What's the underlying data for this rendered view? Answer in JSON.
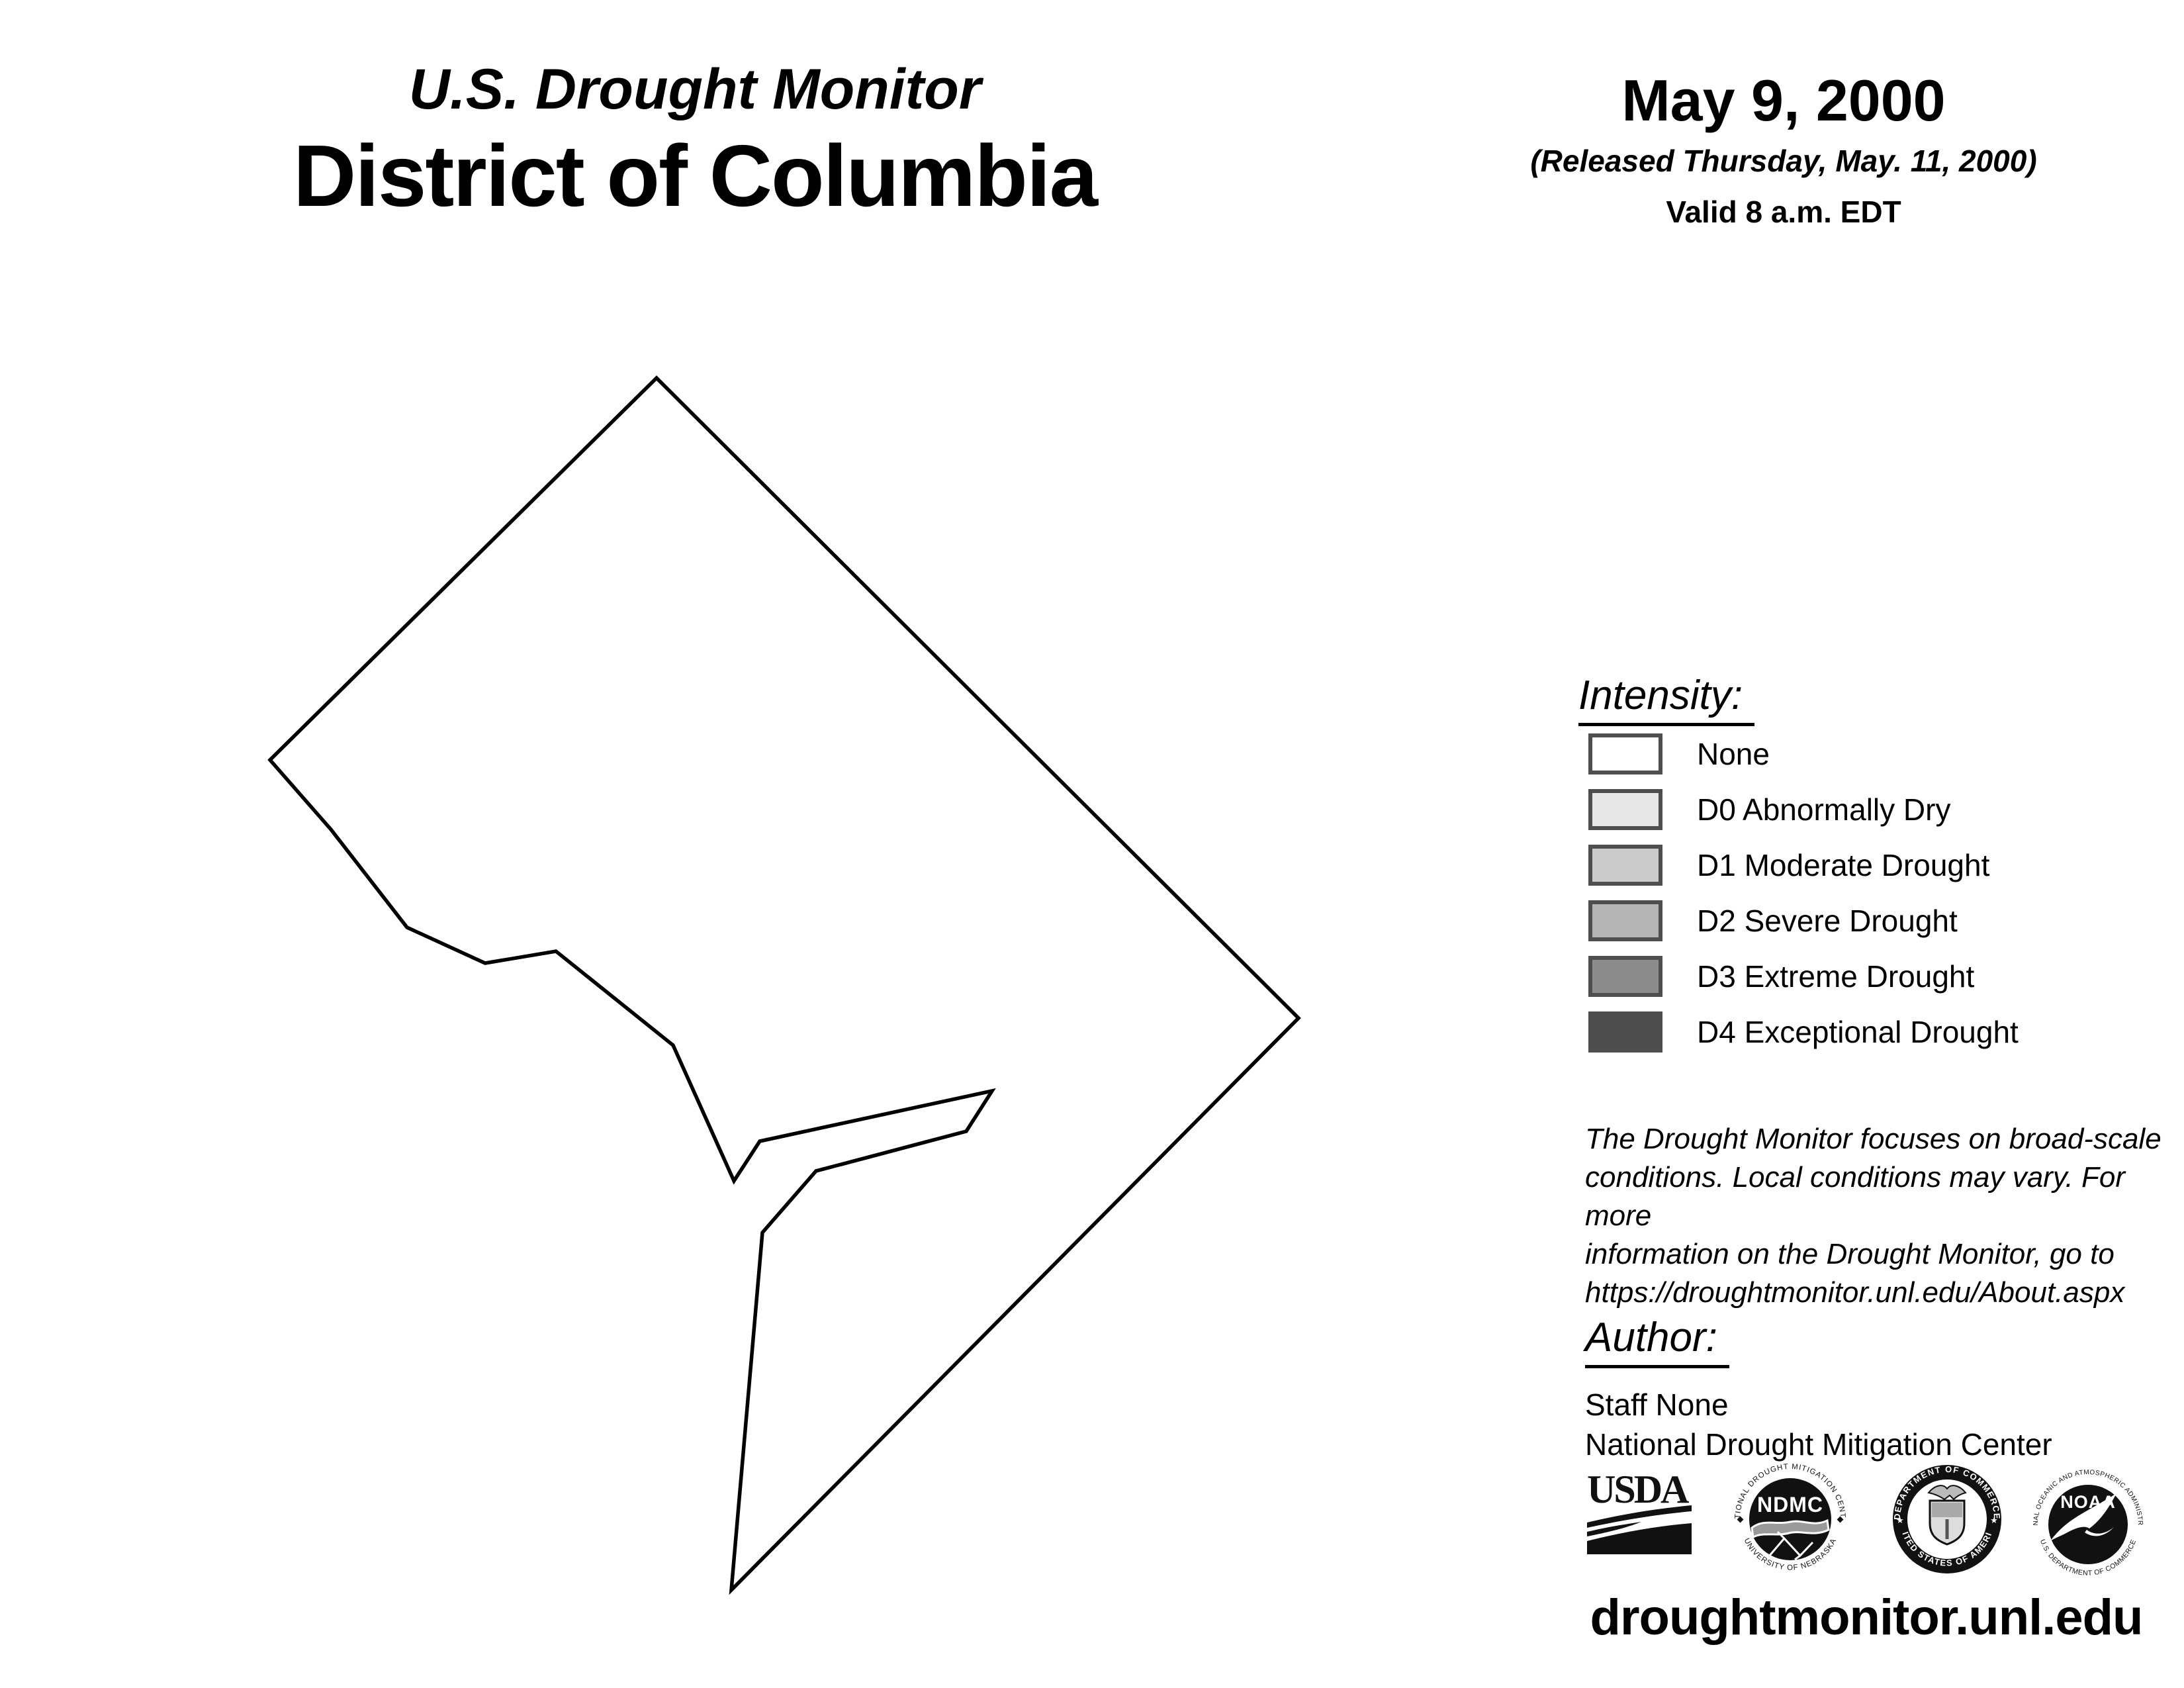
{
  "header": {
    "kicker": "U.S. Drought Monitor",
    "title": "District of Columbia",
    "date": "May 9, 2000",
    "released": "(Released Thursday, May. 11, 2000)",
    "valid": "Valid 8 a.m. EDT"
  },
  "map": {
    "region_name": "District of Columbia",
    "fill_color": "#ffffff",
    "outline_color": "#000000",
    "outline_points": [
      [
        992,
        571
      ],
      [
        1962,
        1538
      ],
      [
        1105,
        2402
      ],
      [
        1152,
        1862
      ],
      [
        1233,
        1769
      ],
      [
        1460,
        1709
      ],
      [
        1499,
        1648
      ],
      [
        1148,
        1724
      ],
      [
        1109,
        1784
      ],
      [
        1017,
        1579
      ],
      [
        840,
        1437
      ],
      [
        733,
        1455
      ],
      [
        615,
        1401
      ],
      [
        500,
        1253
      ],
      [
        408,
        1148
      ]
    ]
  },
  "legend": {
    "heading": "Intensity:",
    "swatch_border_color": "#4e4e4e",
    "items": [
      {
        "label": "None",
        "color": "#ffffff"
      },
      {
        "label": "D0 Abnormally Dry",
        "color": "#e7e7e7"
      },
      {
        "label": "D1 Moderate Drought",
        "color": "#cbcbcb"
      },
      {
        "label": "D2 Severe Drought",
        "color": "#b4b4b4"
      },
      {
        "label": "D3 Extreme Drought",
        "color": "#8c8c8c"
      },
      {
        "label": "D4 Exceptional Drought",
        "color": "#4e4e4e"
      }
    ]
  },
  "disclaimer": {
    "lines": [
      "The Drought Monitor focuses on broad-scale",
      "conditions. Local conditions may vary. For more",
      "information on the Drought Monitor, go to",
      "https://droughtmonitor.unl.edu/About.aspx"
    ]
  },
  "author": {
    "heading": "Author:",
    "name": "Staff None",
    "organization": "National Drought Mitigation Center"
  },
  "footer": {
    "url": "droughtmonitor.unl.edu",
    "logos": {
      "usda": {
        "text": "USDA"
      },
      "ndmc": {
        "text": "NDMC",
        "ring_top": "NATIONAL DROUGHT MITIGATION CENTER",
        "ring_bottom": "UNIVERSITY OF NEBRASKA"
      },
      "doc": {
        "ring_top": "DEPARTMENT OF COMMERCE",
        "ring_bottom": "UNITED STATES OF AMERICA"
      },
      "noaa": {
        "text": "NOAA",
        "ring_top": "NATIONAL OCEANIC AND ATMOSPHERIC ADMINISTRATION",
        "ring_bottom": "U.S. DEPARTMENT OF COMMERCE"
      }
    }
  }
}
